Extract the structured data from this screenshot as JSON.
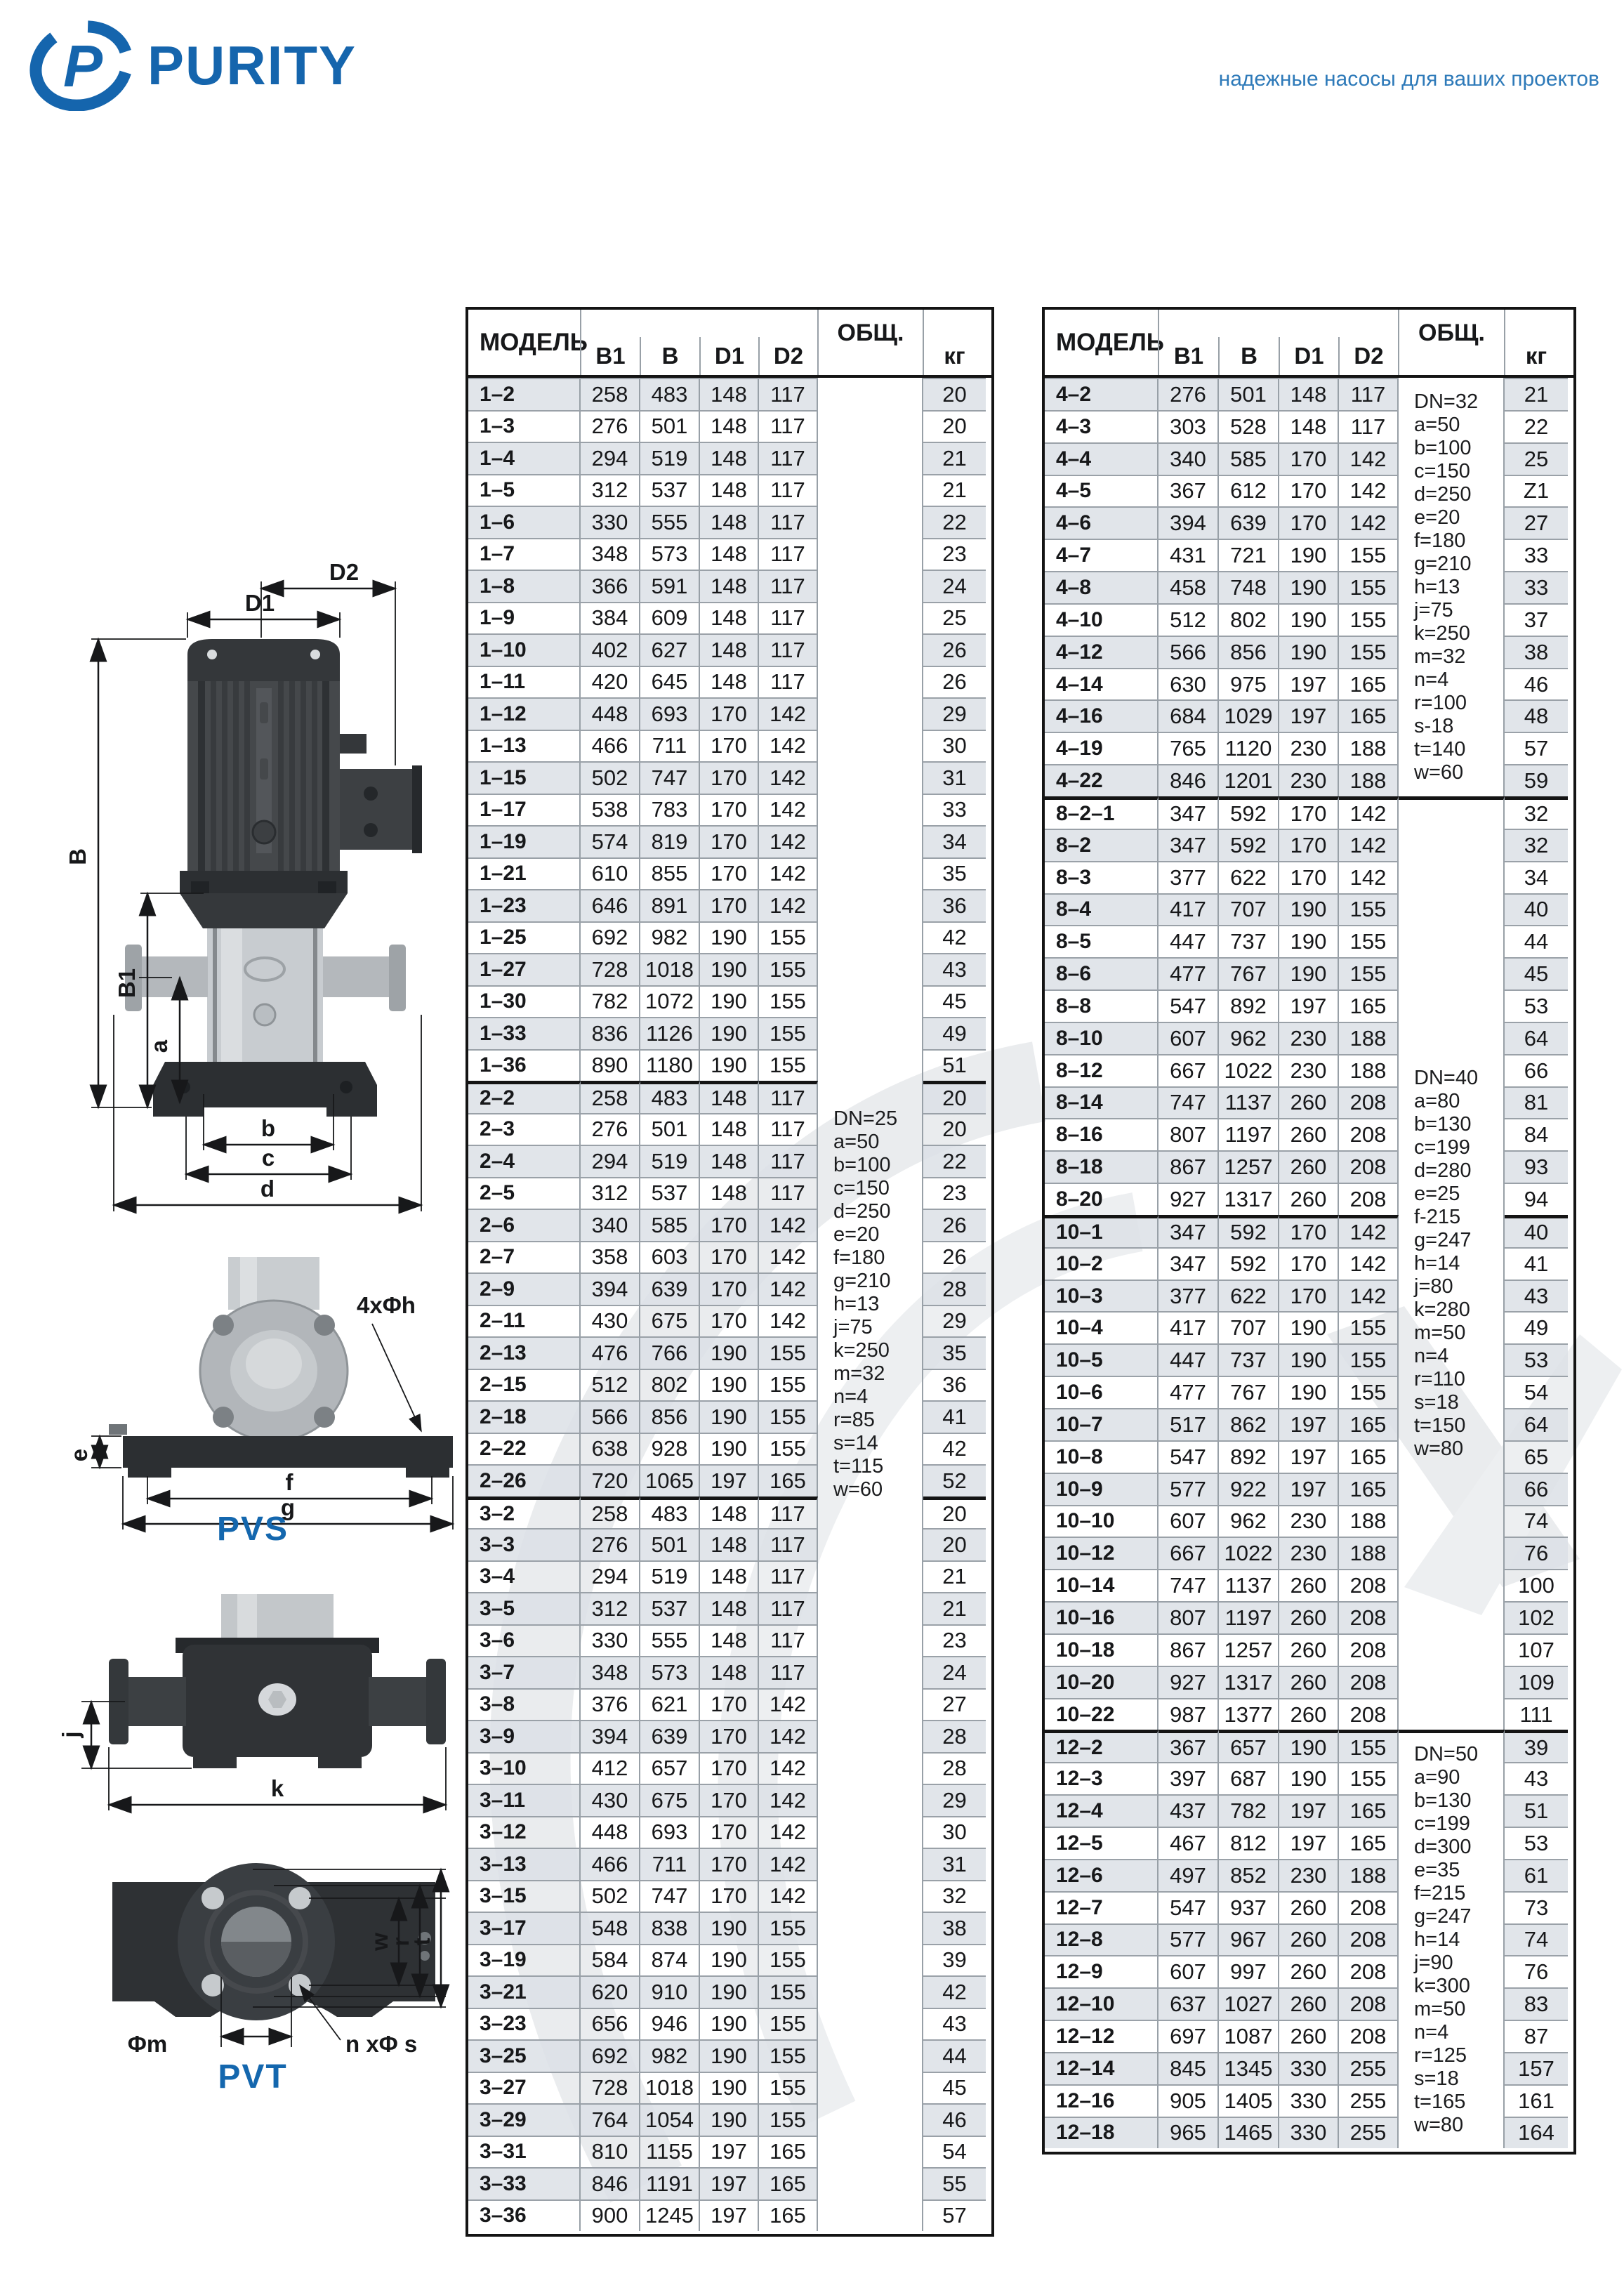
{
  "header": {
    "brand": "PURITY",
    "tagline": "надежные насосы для ваших проектов",
    "brand_color": "#1565ad",
    "tagline_color": "#2e7ab9"
  },
  "diagram": {
    "pvs": "PVS",
    "pvt": "PVT",
    "d1": "D1",
    "d2": "D2",
    "b": "B",
    "b1": "B1",
    "a": "a",
    "bb": "b",
    "c": "c",
    "d": "d",
    "e": "e",
    "f": "f",
    "g": "g",
    "bolt_callout": "4xΦh",
    "j": "j",
    "k": "k",
    "w": "w",
    "r": "r",
    "t": "t",
    "phi_m": "Φm",
    "n_phi_s": "n xΦ s"
  },
  "left_table": {
    "columns": [
      "МОДЕЛЬ",
      "B1",
      "B",
      "D1",
      "D2",
      "ОБЩ.",
      "кг"
    ],
    "notes": [
      "DN=25",
      "a=50",
      "b=100",
      "c=150",
      "d=250",
      "e=20",
      "f=180",
      "g=210",
      "h=13",
      "j=75",
      "k=250",
      "m=32",
      "n=4",
      "r=85",
      "s=14",
      "t=115",
      "w=60"
    ],
    "rows": [
      {
        "m": "1–2",
        "b1": "258",
        "b": "483",
        "d1": "148",
        "d2": "117",
        "kg": "20",
        "s": 1
      },
      {
        "m": "1–3",
        "b1": "276",
        "b": "501",
        "d1": "148",
        "d2": "117",
        "kg": "20"
      },
      {
        "m": "1–4",
        "b1": "294",
        "b": "519",
        "d1": "148",
        "d2": "117",
        "kg": "21",
        "s": 1
      },
      {
        "m": "1–5",
        "b1": "312",
        "b": "537",
        "d1": "148",
        "d2": "117",
        "kg": "21"
      },
      {
        "m": "1–6",
        "b1": "330",
        "b": "555",
        "d1": "148",
        "d2": "117",
        "kg": "22",
        "s": 1
      },
      {
        "m": "1–7",
        "b1": "348",
        "b": "573",
        "d1": "148",
        "d2": "117",
        "kg": "23"
      },
      {
        "m": "1–8",
        "b1": "366",
        "b": "591",
        "d1": "148",
        "d2": "117",
        "kg": "24",
        "s": 1
      },
      {
        "m": "1–9",
        "b1": "384",
        "b": "609",
        "d1": "148",
        "d2": "117",
        "kg": "25"
      },
      {
        "m": "1–10",
        "b1": "402",
        "b": "627",
        "d1": "148",
        "d2": "117",
        "kg": "26",
        "s": 1
      },
      {
        "m": "1–11",
        "b1": "420",
        "b": "645",
        "d1": "148",
        "d2": "117",
        "kg": "26"
      },
      {
        "m": "1–12",
        "b1": "448",
        "b": "693",
        "d1": "170",
        "d2": "142",
        "kg": "29",
        "s": 1
      },
      {
        "m": "1–13",
        "b1": "466",
        "b": "711",
        "d1": "170",
        "d2": "142",
        "kg": "30"
      },
      {
        "m": "1–15",
        "b1": "502",
        "b": "747",
        "d1": "170",
        "d2": "142",
        "kg": "31",
        "s": 1
      },
      {
        "m": "1–17",
        "b1": "538",
        "b": "783",
        "d1": "170",
        "d2": "142",
        "kg": "33"
      },
      {
        "m": "1–19",
        "b1": "574",
        "b": "819",
        "d1": "170",
        "d2": "142",
        "kg": "34",
        "s": 1
      },
      {
        "m": "1–21",
        "b1": "610",
        "b": "855",
        "d1": "170",
        "d2": "142",
        "kg": "35"
      },
      {
        "m": "1–23",
        "b1": "646",
        "b": "891",
        "d1": "170",
        "d2": "142",
        "kg": "36",
        "s": 1
      },
      {
        "m": "1–25",
        "b1": "692",
        "b": "982",
        "d1": "190",
        "d2": "155",
        "kg": "42"
      },
      {
        "m": "1–27",
        "b1": "728",
        "b": "1018",
        "d1": "190",
        "d2": "155",
        "kg": "43",
        "s": 1
      },
      {
        "m": "1–30",
        "b1": "782",
        "b": "1072",
        "d1": "190",
        "d2": "155",
        "kg": "45"
      },
      {
        "m": "1–33",
        "b1": "836",
        "b": "1126",
        "d1": "190",
        "d2": "155",
        "kg": "49",
        "s": 1
      },
      {
        "m": "1–36",
        "b1": "890",
        "b": "1180",
        "d1": "190",
        "d2": "155",
        "kg": "51"
      },
      {
        "m": "2–2",
        "b1": "258",
        "b": "483",
        "d1": "148",
        "d2": "117",
        "kg": "20",
        "s": 1,
        "g": 1
      },
      {
        "m": "2–3",
        "b1": "276",
        "b": "501",
        "d1": "148",
        "d2": "117",
        "kg": "20"
      },
      {
        "m": "2–4",
        "b1": "294",
        "b": "519",
        "d1": "148",
        "d2": "117",
        "kg": "22",
        "s": 1
      },
      {
        "m": "2–5",
        "b1": "312",
        "b": "537",
        "d1": "148",
        "d2": "117",
        "kg": "23"
      },
      {
        "m": "2–6",
        "b1": "340",
        "b": "585",
        "d1": "170",
        "d2": "142",
        "kg": "26",
        "s": 1
      },
      {
        "m": "2–7",
        "b1": "358",
        "b": "603",
        "d1": "170",
        "d2": "142",
        "kg": "26"
      },
      {
        "m": "2–9",
        "b1": "394",
        "b": "639",
        "d1": "170",
        "d2": "142",
        "kg": "28",
        "s": 1
      },
      {
        "m": "2–11",
        "b1": "430",
        "b": "675",
        "d1": "170",
        "d2": "142",
        "kg": "29"
      },
      {
        "m": "2–13",
        "b1": "476",
        "b": "766",
        "d1": "190",
        "d2": "155",
        "kg": "35",
        "s": 1
      },
      {
        "m": "2–15",
        "b1": "512",
        "b": "802",
        "d1": "190",
        "d2": "155",
        "kg": "36"
      },
      {
        "m": "2–18",
        "b1": "566",
        "b": "856",
        "d1": "190",
        "d2": "155",
        "kg": "41",
        "s": 1
      },
      {
        "m": "2–22",
        "b1": "638",
        "b": "928",
        "d1": "190",
        "d2": "155",
        "kg": "42"
      },
      {
        "m": "2–26",
        "b1": "720",
        "b": "1065",
        "d1": "197",
        "d2": "165",
        "kg": "52",
        "s": 1
      },
      {
        "m": "3–2",
        "b1": "258",
        "b": "483",
        "d1": "148",
        "d2": "117",
        "kg": "20",
        "g": 1
      },
      {
        "m": "3–3",
        "b1": "276",
        "b": "501",
        "d1": "148",
        "d2": "117",
        "kg": "20",
        "s": 1
      },
      {
        "m": "3–4",
        "b1": "294",
        "b": "519",
        "d1": "148",
        "d2": "117",
        "kg": "21"
      },
      {
        "m": "3–5",
        "b1": "312",
        "b": "537",
        "d1": "148",
        "d2": "117",
        "kg": "21",
        "s": 1
      },
      {
        "m": "3–6",
        "b1": "330",
        "b": "555",
        "d1": "148",
        "d2": "117",
        "kg": "23"
      },
      {
        "m": "3–7",
        "b1": "348",
        "b": "573",
        "d1": "148",
        "d2": "117",
        "kg": "24",
        "s": 1
      },
      {
        "m": "3–8",
        "b1": "376",
        "b": "621",
        "d1": "170",
        "d2": "142",
        "kg": "27"
      },
      {
        "m": "3–9",
        "b1": "394",
        "b": "639",
        "d1": "170",
        "d2": "142",
        "kg": "28",
        "s": 1
      },
      {
        "m": "3–10",
        "b1": "412",
        "b": "657",
        "d1": "170",
        "d2": "142",
        "kg": "28"
      },
      {
        "m": "3–11",
        "b1": "430",
        "b": "675",
        "d1": "170",
        "d2": "142",
        "kg": "29",
        "s": 1
      },
      {
        "m": "3–12",
        "b1": "448",
        "b": "693",
        "d1": "170",
        "d2": "142",
        "kg": "30"
      },
      {
        "m": "3–13",
        "b1": "466",
        "b": "711",
        "d1": "170",
        "d2": "142",
        "kg": "31",
        "s": 1
      },
      {
        "m": "3–15",
        "b1": "502",
        "b": "747",
        "d1": "170",
        "d2": "142",
        "kg": "32"
      },
      {
        "m": "3–17",
        "b1": "548",
        "b": "838",
        "d1": "190",
        "d2": "155",
        "kg": "38",
        "s": 1
      },
      {
        "m": "3–19",
        "b1": "584",
        "b": "874",
        "d1": "190",
        "d2": "155",
        "kg": "39"
      },
      {
        "m": "3–21",
        "b1": "620",
        "b": "910",
        "d1": "190",
        "d2": "155",
        "kg": "42",
        "s": 1
      },
      {
        "m": "3–23",
        "b1": "656",
        "b": "946",
        "d1": "190",
        "d2": "155",
        "kg": "43"
      },
      {
        "m": "3–25",
        "b1": "692",
        "b": "982",
        "d1": "190",
        "d2": "155",
        "kg": "44",
        "s": 1
      },
      {
        "m": "3–27",
        "b1": "728",
        "b": "1018",
        "d1": "190",
        "d2": "155",
        "kg": "45"
      },
      {
        "m": "3–29",
        "b1": "764",
        "b": "1054",
        "d1": "190",
        "d2": "155",
        "kg": "46",
        "s": 1
      },
      {
        "m": "3–31",
        "b1": "810",
        "b": "1155",
        "d1": "197",
        "d2": "165",
        "kg": "54"
      },
      {
        "m": "3–33",
        "b1": "846",
        "b": "1191",
        "d1": "197",
        "d2": "165",
        "kg": "55",
        "s": 1
      },
      {
        "m": "3–36",
        "b1": "900",
        "b": "1245",
        "d1": "197",
        "d2": "165",
        "kg": "57"
      }
    ]
  },
  "right_table": {
    "columns": [
      "МОДЕЛЬ",
      "B1",
      "B",
      "D1",
      "D2",
      "ОБЩ.",
      "кг"
    ],
    "note_blocks": [
      {
        "lines": [
          "DN=32",
          "a=50",
          "b=100",
          "c=150",
          "d=250",
          "e=20",
          "f=180",
          "g=210",
          "h=13",
          "j=75",
          "k=250",
          "m=32",
          "n=4",
          "r=100",
          "s-18",
          "t=140",
          "w=60"
        ]
      },
      {
        "lines": [
          "DN=40",
          "a=80",
          "b=130",
          "c=199",
          "d=280",
          "e=25",
          "f-215",
          "g=247",
          "h=14",
          "j=80",
          "k=280",
          "m=50",
          "n=4",
          "r=110",
          "s=18",
          "t=150",
          "w=80"
        ]
      },
      {
        "lines": [
          "DN=50",
          "a=90",
          "b=130",
          "c=199",
          "d=300",
          "e=35",
          "f=215",
          "g=247",
          "h=14",
          "j=90",
          "k=300",
          "m=50",
          "n=4",
          "r=125",
          "s=18",
          "t=165",
          "w=80"
        ]
      }
    ],
    "rows": [
      {
        "m": "4–2",
        "b1": "276",
        "b": "501",
        "d1": "148",
        "d2": "117",
        "kg": "21",
        "s": 1
      },
      {
        "m": "4–3",
        "b1": "303",
        "b": "528",
        "d1": "148",
        "d2": "117",
        "kg": "22"
      },
      {
        "m": "4–4",
        "b1": "340",
        "b": "585",
        "d1": "170",
        "d2": "142",
        "kg": "25",
        "s": 1
      },
      {
        "m": "4–5",
        "b1": "367",
        "b": "612",
        "d1": "170",
        "d2": "142",
        "kg": "Z1"
      },
      {
        "m": "4–6",
        "b1": "394",
        "b": "639",
        "d1": "170",
        "d2": "142",
        "kg": "27",
        "s": 1
      },
      {
        "m": "4–7",
        "b1": "431",
        "b": "721",
        "d1": "190",
        "d2": "155",
        "kg": "33"
      },
      {
        "m": "4–8",
        "b1": "458",
        "b": "748",
        "d1": "190",
        "d2": "155",
        "kg": "33",
        "s": 1
      },
      {
        "m": "4–10",
        "b1": "512",
        "b": "802",
        "d1": "190",
        "d2": "155",
        "kg": "37"
      },
      {
        "m": "4–12",
        "b1": "566",
        "b": "856",
        "d1": "190",
        "d2": "155",
        "kg": "38",
        "s": 1
      },
      {
        "m": "4–14",
        "b1": "630",
        "b": "975",
        "d1": "197",
        "d2": "165",
        "kg": "46"
      },
      {
        "m": "4–16",
        "b1": "684",
        "b": "1029",
        "d1": "197",
        "d2": "165",
        "kg": "48",
        "s": 1
      },
      {
        "m": "4–19",
        "b1": "765",
        "b": "1120",
        "d1": "230",
        "d2": "188",
        "kg": "57"
      },
      {
        "m": "4–22",
        "b1": "846",
        "b": "1201",
        "d1": "230",
        "d2": "188",
        "kg": "59",
        "s": 1
      },
      {
        "m": "8–2–1",
        "b1": "347",
        "b": "592",
        "d1": "170",
        "d2": "142",
        "kg": "32",
        "g": 1,
        "go": 1
      },
      {
        "m": "8–2",
        "b1": "347",
        "b": "592",
        "d1": "170",
        "d2": "142",
        "kg": "32",
        "s": 1
      },
      {
        "m": "8–3",
        "b1": "377",
        "b": "622",
        "d1": "170",
        "d2": "142",
        "kg": "34"
      },
      {
        "m": "8–4",
        "b1": "417",
        "b": "707",
        "d1": "190",
        "d2": "155",
        "kg": "40",
        "s": 1
      },
      {
        "m": "8–5",
        "b1": "447",
        "b": "737",
        "d1": "190",
        "d2": "155",
        "kg": "44"
      },
      {
        "m": "8–6",
        "b1": "477",
        "b": "767",
        "d1": "190",
        "d2": "155",
        "kg": "45",
        "s": 1
      },
      {
        "m": "8–8",
        "b1": "547",
        "b": "892",
        "d1": "197",
        "d2": "165",
        "kg": "53"
      },
      {
        "m": "8–10",
        "b1": "607",
        "b": "962",
        "d1": "230",
        "d2": "188",
        "kg": "64",
        "s": 1
      },
      {
        "m": "8–12",
        "b1": "667",
        "b": "1022",
        "d1": "230",
        "d2": "188",
        "kg": "66"
      },
      {
        "m": "8–14",
        "b1": "747",
        "b": "1137",
        "d1": "260",
        "d2": "208",
        "kg": "81",
        "s": 1
      },
      {
        "m": "8–16",
        "b1": "807",
        "b": "1197",
        "d1": "260",
        "d2": "208",
        "kg": "84"
      },
      {
        "m": "8–18",
        "b1": "867",
        "b": "1257",
        "d1": "260",
        "d2": "208",
        "kg": "93",
        "s": 1
      },
      {
        "m": "8–20",
        "b1": "927",
        "b": "1317",
        "d1": "260",
        "d2": "208",
        "kg": "94"
      },
      {
        "m": "10–1",
        "b1": "347",
        "b": "592",
        "d1": "170",
        "d2": "142",
        "kg": "40",
        "s": 1,
        "g": 1
      },
      {
        "m": "10–2",
        "b1": "347",
        "b": "592",
        "d1": "170",
        "d2": "142",
        "kg": "41"
      },
      {
        "m": "10–3",
        "b1": "377",
        "b": "622",
        "d1": "170",
        "d2": "142",
        "kg": "43",
        "s": 1
      },
      {
        "m": "10–4",
        "b1": "417",
        "b": "707",
        "d1": "190",
        "d2": "155",
        "kg": "49"
      },
      {
        "m": "10–5",
        "b1": "447",
        "b": "737",
        "d1": "190",
        "d2": "155",
        "kg": "53",
        "s": 1
      },
      {
        "m": "10–6",
        "b1": "477",
        "b": "767",
        "d1": "190",
        "d2": "155",
        "kg": "54"
      },
      {
        "m": "10–7",
        "b1": "517",
        "b": "862",
        "d1": "197",
        "d2": "165",
        "kg": "64",
        "s": 1
      },
      {
        "m": "10–8",
        "b1": "547",
        "b": "892",
        "d1": "197",
        "d2": "165",
        "kg": "65"
      },
      {
        "m": "10–9",
        "b1": "577",
        "b": "922",
        "d1": "197",
        "d2": "165",
        "kg": "66",
        "s": 1
      },
      {
        "m": "10–10",
        "b1": "607",
        "b": "962",
        "d1": "230",
        "d2": "188",
        "kg": "74"
      },
      {
        "m": "10–12",
        "b1": "667",
        "b": "1022",
        "d1": "230",
        "d2": "188",
        "kg": "76",
        "s": 1
      },
      {
        "m": "10–14",
        "b1": "747",
        "b": "1137",
        "d1": "260",
        "d2": "208",
        "kg": "100"
      },
      {
        "m": "10–16",
        "b1": "807",
        "b": "1197",
        "d1": "260",
        "d2": "208",
        "kg": "102",
        "s": 1
      },
      {
        "m": "10–18",
        "b1": "867",
        "b": "1257",
        "d1": "260",
        "d2": "208",
        "kg": "107"
      },
      {
        "m": "10–20",
        "b1": "927",
        "b": "1317",
        "d1": "260",
        "d2": "208",
        "kg": "109",
        "s": 1
      },
      {
        "m": "10–22",
        "b1": "987",
        "b": "1377",
        "d1": "260",
        "d2": "208",
        "kg": "111"
      },
      {
        "m": "12–2",
        "b1": "367",
        "b": "657",
        "d1": "190",
        "d2": "155",
        "kg": "39",
        "s": 1,
        "g": 1,
        "go": 1
      },
      {
        "m": "12–3",
        "b1": "397",
        "b": "687",
        "d1": "190",
        "d2": "155",
        "kg": "43"
      },
      {
        "m": "12–4",
        "b1": "437",
        "b": "782",
        "d1": "197",
        "d2": "165",
        "kg": "51",
        "s": 1
      },
      {
        "m": "12–5",
        "b1": "467",
        "b": "812",
        "d1": "197",
        "d2": "165",
        "kg": "53"
      },
      {
        "m": "12–6",
        "b1": "497",
        "b": "852",
        "d1": "230",
        "d2": "188",
        "kg": "61",
        "s": 1
      },
      {
        "m": "12–7",
        "b1": "547",
        "b": "937",
        "d1": "260",
        "d2": "208",
        "kg": "73"
      },
      {
        "m": "12–8",
        "b1": "577",
        "b": "967",
        "d1": "260",
        "d2": "208",
        "kg": "74",
        "s": 1
      },
      {
        "m": "12–9",
        "b1": "607",
        "b": "997",
        "d1": "260",
        "d2": "208",
        "kg": "76"
      },
      {
        "m": "12–10",
        "b1": "637",
        "b": "1027",
        "d1": "260",
        "d2": "208",
        "kg": "83",
        "s": 1
      },
      {
        "m": "12–12",
        "b1": "697",
        "b": "1087",
        "d1": "260",
        "d2": "208",
        "kg": "87"
      },
      {
        "m": "12–14",
        "b1": "845",
        "b": "1345",
        "d1": "330",
        "d2": "255",
        "kg": "157",
        "s": 1
      },
      {
        "m": "12–16",
        "b1": "905",
        "b": "1405",
        "d1": "330",
        "d2": "255",
        "kg": "161"
      },
      {
        "m": "12–18",
        "b1": "965",
        "b": "1465",
        "d1": "330",
        "d2": "255",
        "kg": "164",
        "s": 1
      }
    ]
  }
}
